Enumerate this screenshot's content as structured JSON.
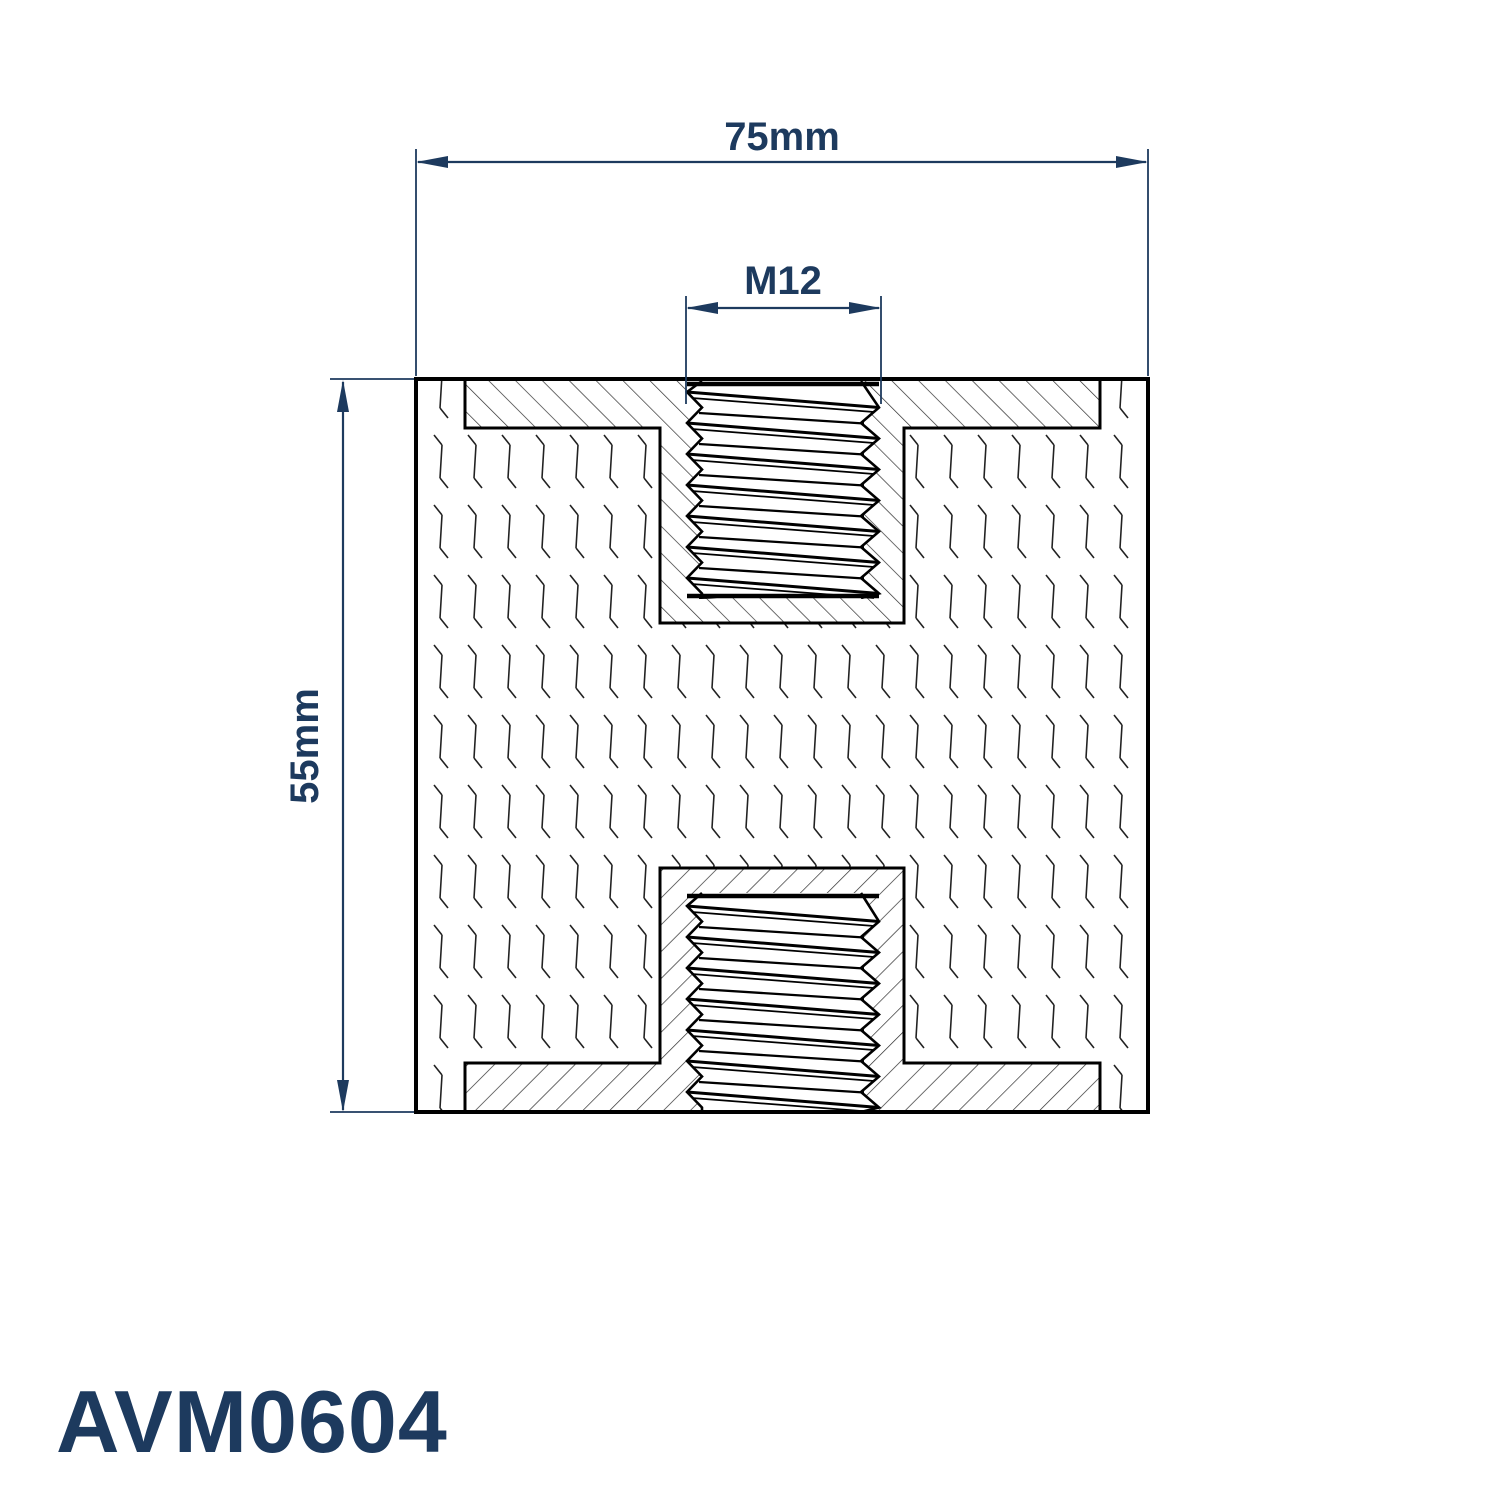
{
  "annotations": {
    "width_dim": "75mm",
    "thread_dim": "M12",
    "height_dim": "55mm"
  },
  "part_number": "AVM0604",
  "colors": {
    "annotation_navy": "#1d3a5e",
    "line_black": "#000000",
    "background": "#ffffff"
  }
}
